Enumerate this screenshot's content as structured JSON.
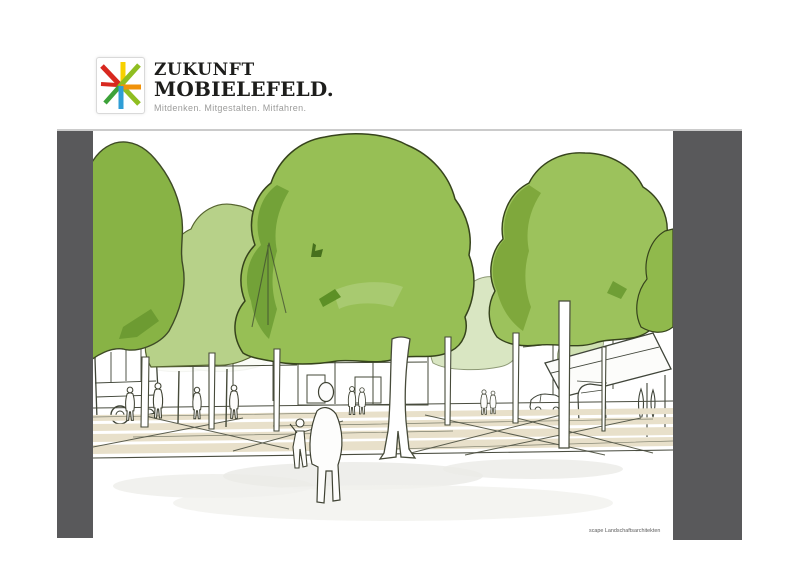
{
  "logo": {
    "title_line1": "ZUKUNFT",
    "title_line2": "MOBIELEFELD.",
    "tagline": "Mitdenken. Mitgestalten. Mitfahren.",
    "icon": "transit-junction-logo-icon",
    "icon_colors": {
      "red": "#d8281f",
      "yellow": "#f7d100",
      "orange": "#f0920a",
      "light_green": "#8fbe21",
      "dark_green": "#3da239",
      "blue": "#2f9ed6"
    }
  },
  "illustration": {
    "credit": "scape Landschaftsarchitekten",
    "colors": {
      "frame_bar_gray": "#59595b",
      "tree_green": "#97bf55",
      "tree_green_dark": "#6f9e35",
      "tree_green_light": "#b7d189",
      "tree_pale": "#d9e6c2",
      "street_beige": "#e8e0ca",
      "sketch_ink": "#3f4437",
      "plaza_wash": "#ebebe7"
    }
  }
}
